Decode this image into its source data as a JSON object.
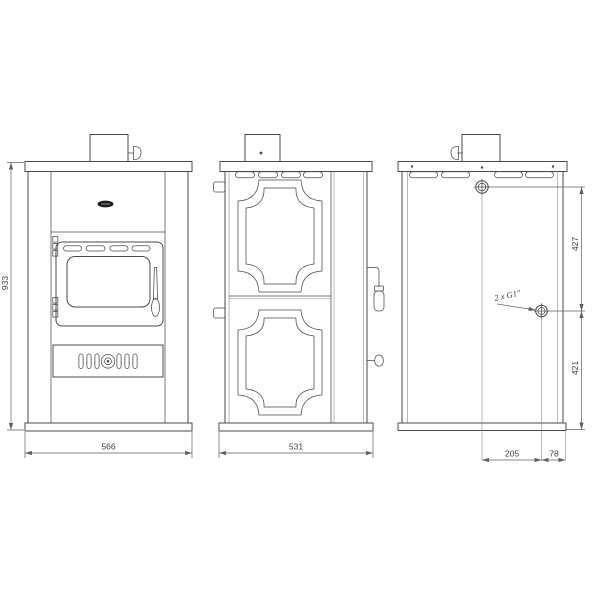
{
  "drawing_labels": {
    "front_height": "933",
    "front_width": "566",
    "side_depth": "531",
    "rear_upper_spacing": "427",
    "rear_lower_spacing": "421",
    "rear_offset_inner": "205",
    "rear_offset_outer": "78",
    "fitting_note": "2 x G1\""
  },
  "colors": {
    "background": "#ffffff",
    "line": "#4a4a4a",
    "dimension": "#5f5f5f",
    "badge": "#1d1d1d"
  }
}
